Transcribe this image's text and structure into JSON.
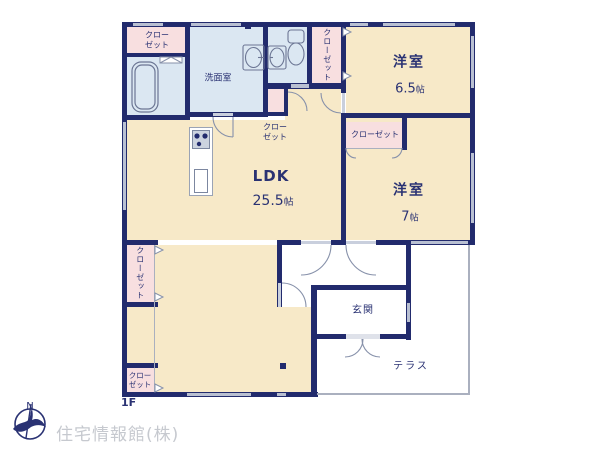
{
  "floor_label": "1F",
  "company": "住宅情報館(株)",
  "compass": {
    "north": "N"
  },
  "rooms": {
    "ldk": {
      "name": "LDK",
      "size_num": "25.5",
      "size_unit": "帖"
    },
    "western1": {
      "name": "洋室",
      "size_num": "6.5",
      "size_unit": "帖"
    },
    "western2": {
      "name": "洋室",
      "size_num": "7",
      "size_unit": "帖"
    },
    "washroom": {
      "name": "洗面室"
    },
    "entrance": {
      "name": "玄関"
    },
    "terrace": {
      "name": "テラス"
    }
  },
  "closets": {
    "top_left": "クロー\nゼット",
    "middle": "クロー\nゼット",
    "hall_vertical": "クローゼット",
    "west2": "クローゼット",
    "ldk_vertical": "クローゼット",
    "bottom_left": "クロー\nゼット"
  },
  "colors": {
    "wall": "#222b6d",
    "beige": "#f7e9c8",
    "blue": "#dbe7f2",
    "pink": "#f8dfe0",
    "window": "#b9c0d2",
    "text": "#2a3273",
    "muted": "#c6c9cf",
    "line": "#aab0bf"
  }
}
